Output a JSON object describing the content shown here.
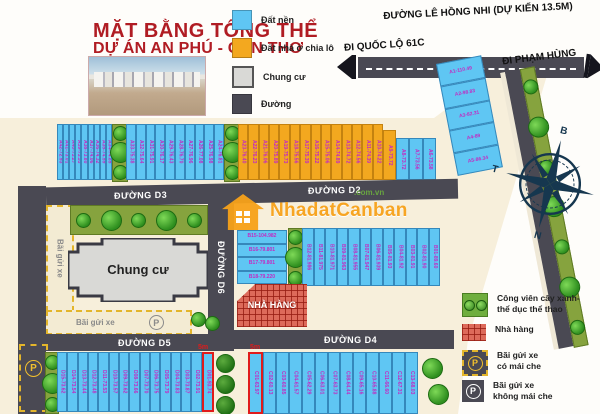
{
  "title": {
    "line1": "MẶT BẰNG TỔNG THỂ",
    "line2": "DỰ ÁN AN PHÚ - CẦN THƠ"
  },
  "legend_top": {
    "items": [
      {
        "label": "Đất nền",
        "color": "#5fc6f3"
      },
      {
        "label": "Đất nhà ở chia lô",
        "color": "#f3a81f"
      },
      {
        "label": "Chung cư",
        "color": "#d9d9d6"
      },
      {
        "label": "Đường",
        "color": "#4a4953"
      }
    ]
  },
  "roads": {
    "le_hong_nhi": "ĐƯỜNG LÊ HỒNG NHI (DỰ KIẾN 13.5M)",
    "quoc_lo": "ĐI QUỐC LỘ 61C",
    "pham_hung": "ĐI PHẠM HÙNG",
    "d2": "ĐƯỜNG D2",
    "d3": "ĐƯỜNG D3",
    "d4": "ĐƯỜNG D4",
    "d5": "ĐƯỜNG D5",
    "d6": "ĐƯỜNG D6"
  },
  "compass": {
    "north": "B",
    "east": "Đ",
    "south": "N",
    "west": "T"
  },
  "watermark": {
    "name": "NhadatCanban",
    "domain": ".com.vn"
  },
  "labels": {
    "chung_cu": "Chung cư",
    "nha_hang": "NHÀ HÀNG",
    "parking_side": "Bãi gửi xe",
    "parking_bottom": "Bãi gửi xe",
    "p": "P",
    "dim_c": "5m",
    "dim_d": "5m"
  },
  "lots": {
    "a_left1": [
      "A42-72.93",
      "A41-73.01",
      "A40-73.27",
      "A39-73.53",
      "A38-73.80",
      "A37-74.06",
      "A36-74.32",
      "A35-74.59",
      "A34-74.85"
    ],
    "a_left2": [
      "A33-75.38",
      "A32-75.64",
      "A31-75.91",
      "A30-76.17",
      "A29-76.43",
      "A28-76.70",
      "A27-76.96",
      "A26-77.08",
      "A25-76.98",
      "A24-76.81"
    ],
    "a_orange": [
      "A23-76.40",
      "A22-76.23",
      "A21-76.06",
      "A20-75.89",
      "A19-75.73",
      "A18-75.56",
      "A17-75.39",
      "A16-75.22",
      "A15-75.06",
      "A14-74.89",
      "A13-74.72",
      "A12-74.56",
      "A11-74.39",
      "A10-74.22"
    ],
    "a9": [
      "A9-73.72"
    ],
    "a_side": [
      "A8-73.72",
      "A7-73.56",
      "A6-73.58"
    ],
    "a_corner": [
      "A1-110.49",
      "A2-98.83",
      "A3-82.31",
      "A4-89",
      "A5-86.34"
    ],
    "b_rows": [
      "B15-104.982",
      "B16-79.801",
      "B17-79.801",
      "B18-79.220"
    ],
    "b_strips": [
      "B12-81.986",
      "B11-81.975",
      "B10-81.971",
      "B09-81.963",
      "B08-81.955",
      "B07-81.947",
      "B06-81.939",
      "B05-81.93",
      "B04-81.92",
      "B03-81.91",
      "B02-81.90",
      "B01-89.60"
    ],
    "c_row": [
      "C01-63.97",
      "C02-60.13",
      "C03-60.85",
      "C04-61.57",
      "C05-62.29",
      "C06-63.01",
      "C07-63.73",
      "C08-64.44",
      "C09-65.16",
      "C10-65.88",
      "C11-66.60",
      "C12-67.31",
      "C13-68.03"
    ],
    "d_row": [
      "D15-73.62",
      "D14-73.54",
      "D13-73.44",
      "D12-73.48",
      "D11-73.53",
      "D10-73.57",
      "D09-73.62",
      "D08-73.66",
      "D07-73.70",
      "D06-73.75",
      "D05-73.79",
      "D04-73.83",
      "D03-73.87",
      "D02-73.91",
      "D01-93.74"
    ]
  },
  "legend_bottom": {
    "park1": "Công viên cây xanh-",
    "park2": "thể dục thể thao",
    "restaurant": "Nhà hàng",
    "cov1": "Bãi gửi xe",
    "cov2": "có mái che",
    "open1": "Bãi gửi xe",
    "open2": "không mái che"
  }
}
